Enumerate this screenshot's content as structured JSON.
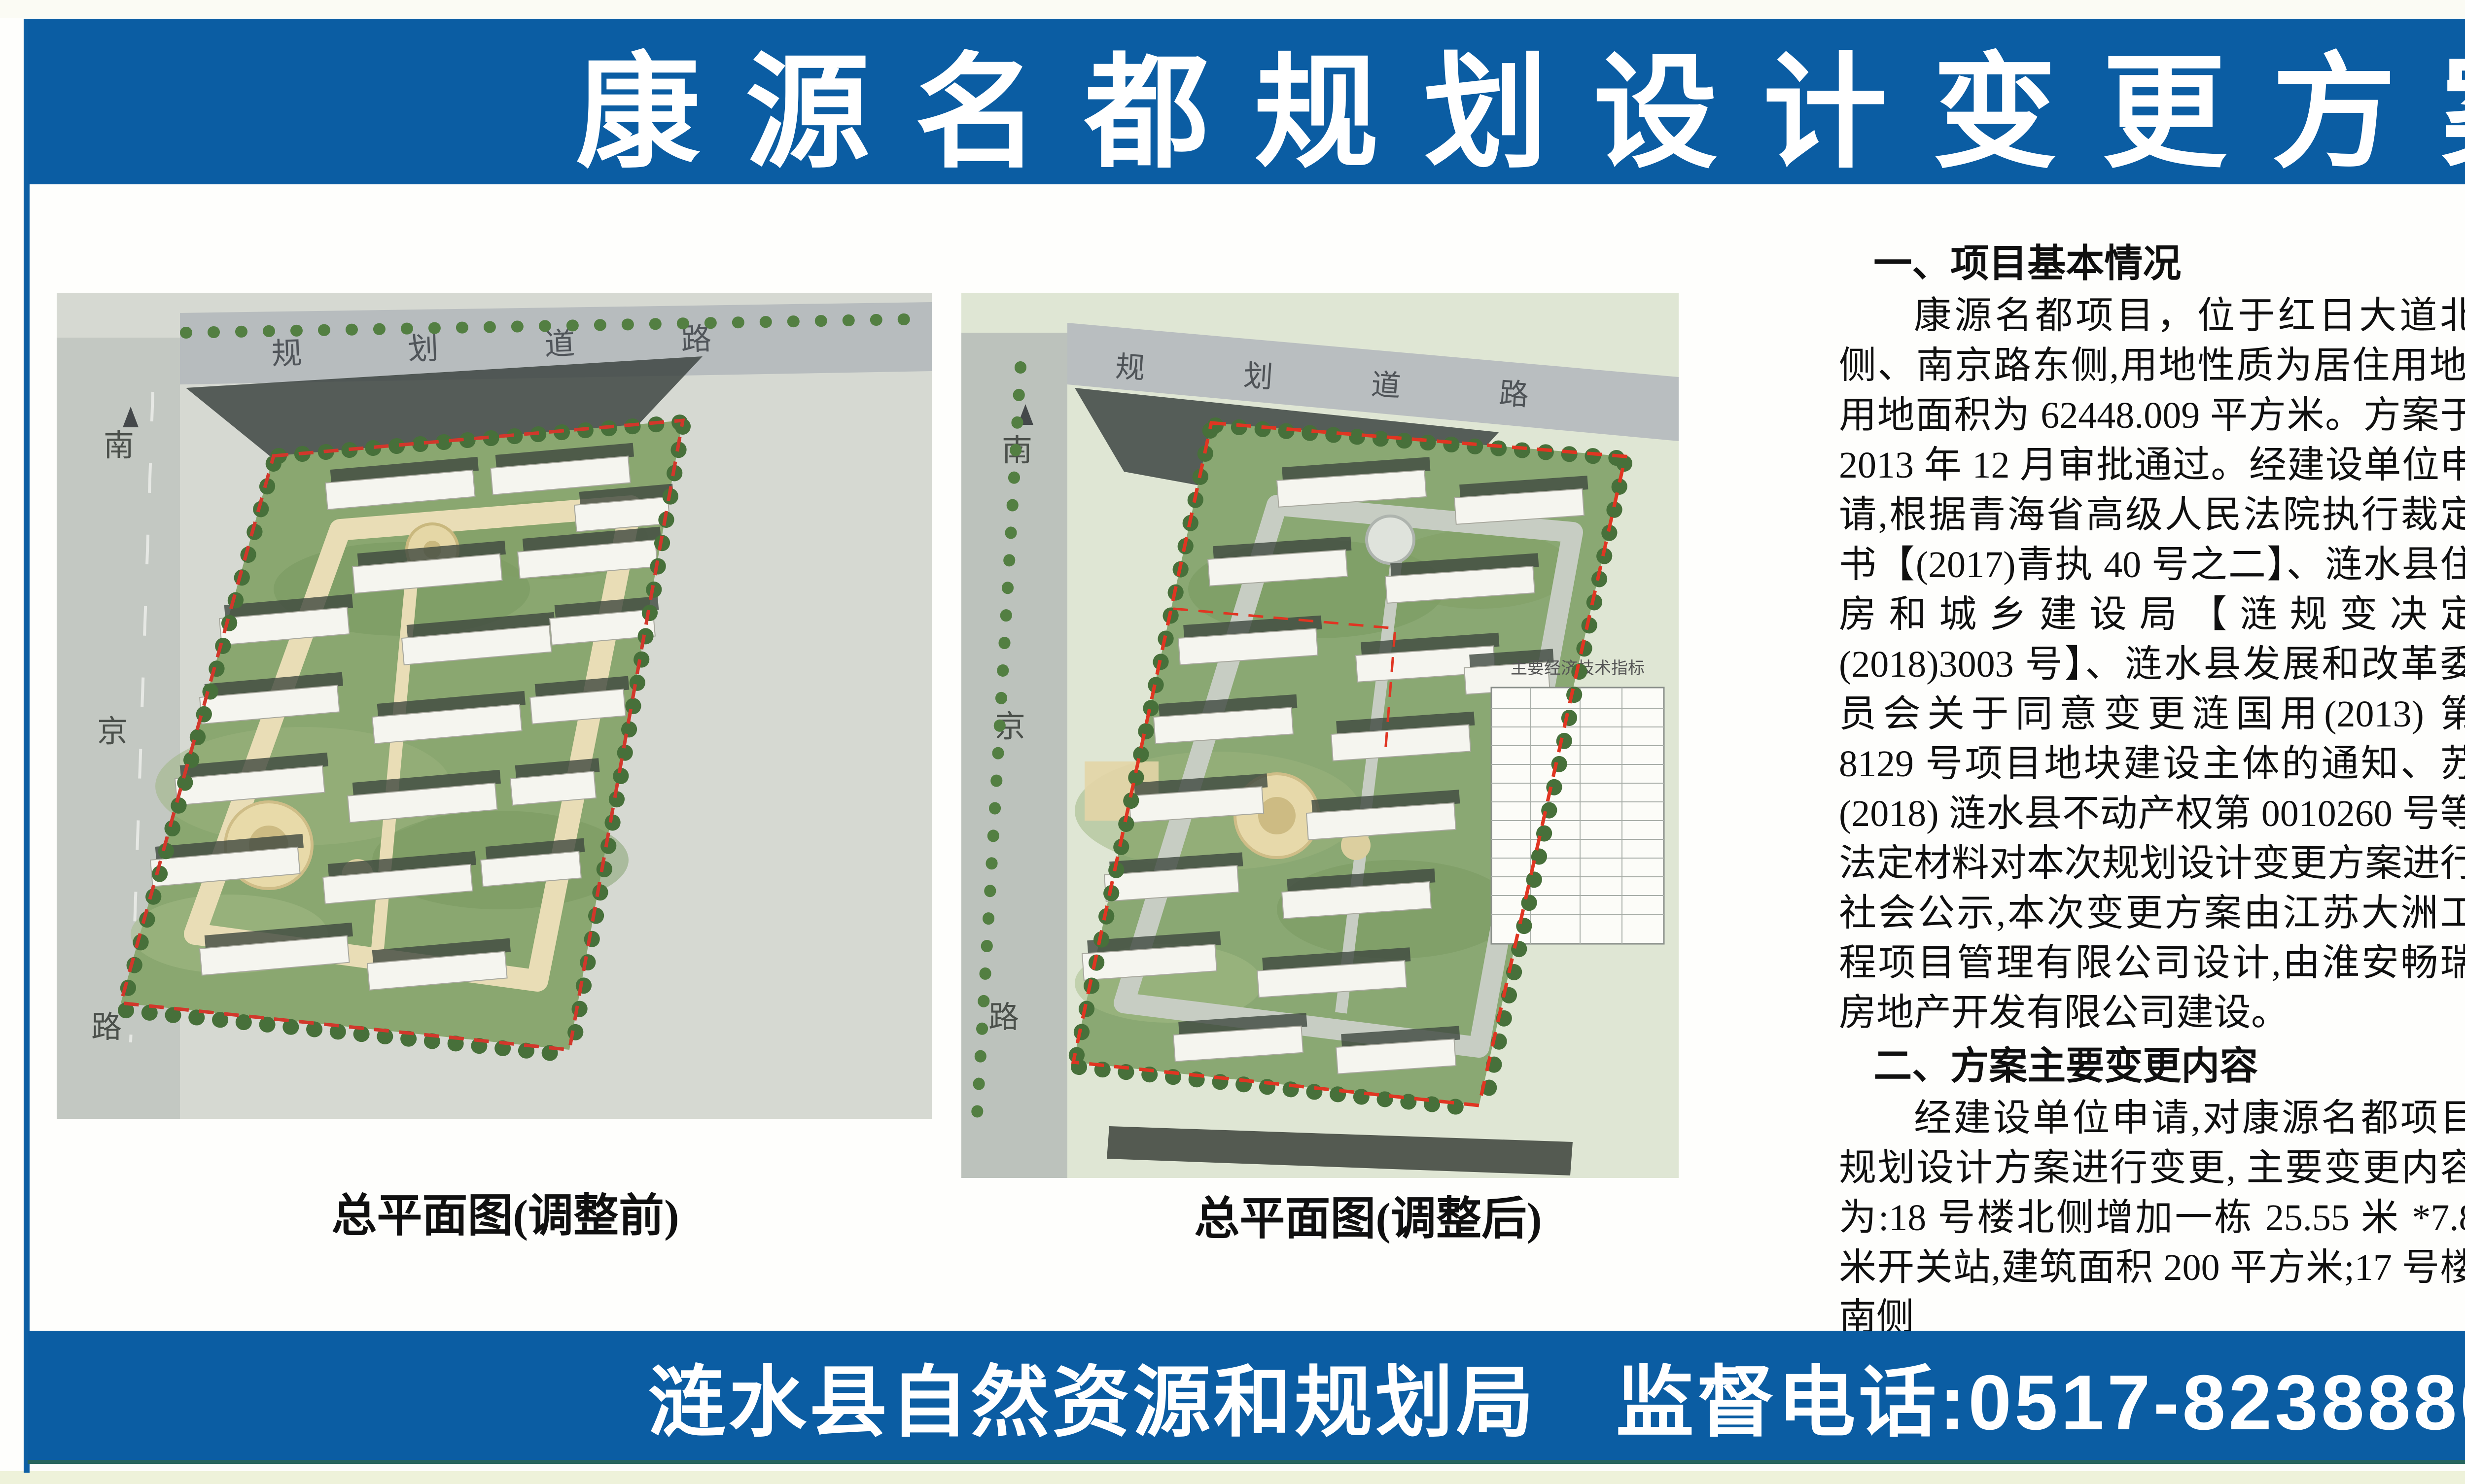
{
  "page": {
    "title": "康源名都规划设计变更方案批前公示",
    "footer": {
      "agency": "涟水县自然资源和规划局",
      "phone": "监督电话:0517-82388806、0517-82380262"
    },
    "colors": {
      "banner_blue": "#0b5da3",
      "rule_blue": "#0d5fa4",
      "boundary_red": "#d2372b",
      "site_green": "#8aa770"
    }
  },
  "figures": [
    {
      "caption": "总平面图(调整前)",
      "road_left": [
        "南",
        "京",
        "路"
      ],
      "road_top": "规划道路"
    },
    {
      "caption": "总平面图(调整后)",
      "road_left": [
        "南",
        "京",
        "路"
      ],
      "road_top": "规划道路",
      "table_title": "主要经济技术指标"
    }
  ],
  "columns": [
    {
      "blocks": [
        {
          "type": "h",
          "text": "一、项目基本情况"
        },
        {
          "type": "p",
          "text": "康源名都项目，位于红日大道北侧、南京路东侧,用地性质为居住用地,用地面积为 62448.009 平方米。方案于 2013 年 12 月审批通过。经建设单位申请,根据青海省高级人民法院执行裁定书【(2017)青执 40 号之二】、涟水县住房和城乡建设局【涟规变决定(2018)3003 号】、涟水县发展和改革委员会关于同意变更涟国用(2013) 第 8129 号项目地块建设主体的通知、苏 (2018) 涟水县不动产权第 0010260 号等法定材料对本次规划设计变更方案进行社会公示,本次变更方案由江苏大洲工程项目管理有限公司设计,由淮安畅瑞房地产开发有限公司建设。"
        },
        {
          "type": "h",
          "text": "二、方案主要变更内容"
        },
        {
          "type": "p",
          "text": "经建设单位申请,对康源名都项目规划设计方案进行变更, 主要变更内容为:18 号楼北侧增加一栋 25.55 米 *7.8 米开关站,建筑面积 200 平方米;17 号楼南侧"
        }
      ]
    },
    {
      "blocks": [
        {
          "type": "pc",
          "text": "配电房由南北向调整为东西向,尺寸保持不变; 在各项指标数据不变的情况下,完善总平面各幢建筑正负零标高及地下车库轮廓线;地面景观进行局部调整。"
        },
        {
          "type": "p",
          "text": "变更前主要经济技术指标:项目建设用地总面积 62448.009 平方米,总建筑面积 182873.12 平方米 (其中计算容积率面积 152523.81 平方米, 不计容建筑面积 30349.31 平方米), 容积率 2.44,建筑密度 18.38%,绿地率 31.2%,总户数 1333 户,机动车停车位 1361 辆(其中商业 28 辆、住宅 1333 辆)。项目中包含物业管理服务用房 740.2 平方米,社区党群服务用房 374.48 平方米。"
        },
        {
          "type": "p",
          "text": "变更后主要经济技术指标:项目建设用地总面积 62448.009 平方米,总建筑面积 183260.05 平方米(其中计算容积率面积 152716.75 平方米, 不计算容积率面积 30543.3 平方米), 容积率 2.45,建筑密度 18.71%,绿地率 30.2%,"
        }
      ]
    },
    {
      "blocks": [
        {
          "type": "pc",
          "text": "总户数 1333 户,机动车停车位 1361 辆(其中商业 28 辆、住宅 1333 辆)。项目中包含物业管理服务用房 740.2 平方米,社区党群服务用房 374.48 平方米。"
        },
        {
          "type": "p",
          "text": "现对该规划设计方案进行批前公示(详见公示附图), 公示时间为 2020 年 12 月 31 日至 2021 年 1 月 14 日。"
        },
        {
          "type": "h",
          "text": "三、公示载体"
        },
        {
          "type": "p",
          "text": "1.《涟水日报》;"
        },
        {
          "type": "p",
          "text": "2. 中国涟水政府门户网站 http://www.lianshui.gov.cn/;"
        },
        {
          "type": "p",
          "text": "3.批准的建设用地现场。"
        },
        {
          "type": "p",
          "text": "如对方案有不同意见或建议, 请于 2021 年 1 月 14 日前, 以书面形式向县自然资源和规划局反映, 或者向局法规科提出听证申请。"
        },
        {
          "type": "p",
          "text": "联系人:皇月荣、陈铁"
        },
        {
          "type": "p",
          "text": "联系电话:0517-82388806、"
        },
        {
          "type": "ctr",
          "text": "0517-82380262"
        },
        {
          "type": "ctr",
          "text": "2020 年 12 月 31 日"
        }
      ]
    }
  ]
}
